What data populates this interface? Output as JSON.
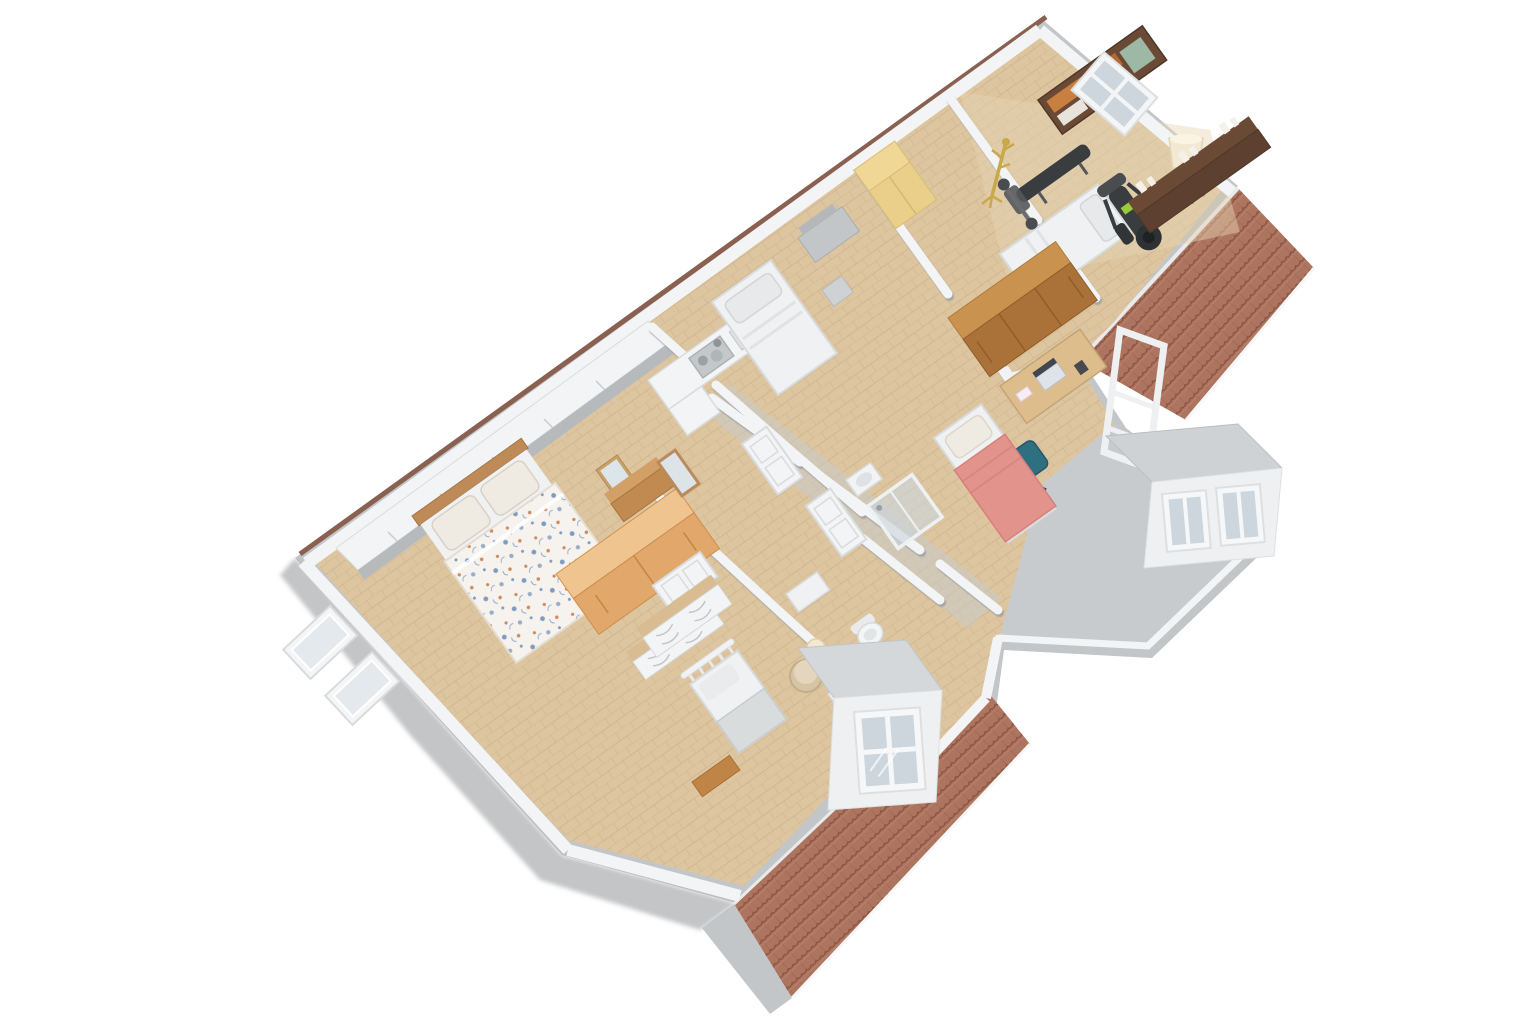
{
  "meta": {
    "description": "3D axonometric floor plan render of an attic apartment, rotated ~35 degrees, floating on a plain white background",
    "view": "top-down isometric cutaway, no labels or UI chrome visible",
    "background": "#ffffff"
  },
  "palette": {
    "slab": "#c3c6c8",
    "slabDark": "#aaadaf",
    "wallTop": "#f3f4f5",
    "wallSide": "#b7babc",
    "wallShadow": "#a2a6a8",
    "wallCapBrown": "#8a6150",
    "floor": "#ddc5a0",
    "floorLight": "#e7d4b4",
    "plankLine": "#c6a87e",
    "grayZone": "#c8cbcd",
    "roofTile": "#ad7560",
    "roofTileDark": "#8a5441",
    "roofTileLight": "#c48d77",
    "roofEdge": "#e8eaeb",
    "pineWood": "#e2a76b",
    "pineWoodTop": "#f0c48f",
    "oakWood": "#aa7238",
    "oakWoodTop": "#c9924e",
    "deskWood": "#ddbd8c",
    "darkWood": "#5d4030",
    "darkWoodTop": "#6b4a35",
    "yellowWardrobe": "#e9cf8a",
    "coralBlanket": "#e2948c",
    "tealChair": "#2e6f80",
    "gymEquipment": "#3a3d40",
    "greenAccent": "#9acb3c",
    "gold": "#c9a84c",
    "lampShade": "#f3e9d3",
    "mattress": "#f0f1f2",
    "pillow": "#efeae2",
    "glass": "#ccd6dc",
    "duvetBlue": "#7f9cc0",
    "duvetOrange": "#cf8a5e"
  },
  "scene": {
    "building": {
      "shape": "long rectangle rotated ~-35deg with beveled top-right corner and stepped lower edge",
      "walls": "white with gray sides, thin brown cap on upper-left exterior wall"
    },
    "roofs": [
      {
        "name": "right-roof",
        "material": "terracotta-tiles",
        "position": "upper-right, sloping down-right"
      },
      {
        "name": "bottom-roof",
        "material": "terracotta-tiles",
        "position": "bottom-center, sloping down-left"
      }
    ],
    "dormers": [
      {
        "name": "right-dormer",
        "windows": 2,
        "position": "right corner"
      },
      {
        "name": "bottom-dormer",
        "windows": 1,
        "position": "on bottom roof"
      },
      {
        "name": "open-window-frame",
        "windows": 0,
        "position": "standing frame at right roof edge"
      }
    ],
    "rooms": [
      {
        "name": "master-bedroom",
        "floor": "light wood",
        "furniture": [
          "wood-headboard",
          "two-pillows",
          "floral-duvet-double-bed",
          "pine-wardrobe",
          "white-dresser",
          "standing-mirror",
          "french-doors"
        ]
      },
      {
        "name": "kitchen",
        "floor": "light wood",
        "furniture": [
          "white-l-counter",
          "sink-with-dishes",
          "white-wall-closets"
        ]
      },
      {
        "name": "middle-bedroom",
        "floor": "light wood",
        "furniture": [
          "white-single-bed",
          "gray-vanity-desk",
          "stool",
          "yellow-wardrobe"
        ]
      },
      {
        "name": "study-bedroom",
        "floor": "light wood",
        "furniture": [
          "white-double-bed",
          "oak-wardrobe",
          "desk-with-laptop",
          "teal-office-chair",
          "coral-single-bed"
        ]
      },
      {
        "name": "home-gym",
        "floor": "light wood",
        "furniture": [
          "dark-bookshelf",
          "gold-coat-rack",
          "weight-bench",
          "elliptical-trainer",
          "tripod-floor-lamp",
          "dark-sideboard-with-candles",
          "roof-window"
        ]
      },
      {
        "name": "kids-room",
        "floor": "light wood",
        "furniture": [
          "slatted-single-bed",
          "wood-bench",
          "white-dresser",
          "side-table-with-lamp"
        ]
      },
      {
        "name": "bathroom",
        "floor": "light wood",
        "furniture": [
          "glass-shower",
          "wash-basin",
          "toilet",
          "laundry-basket",
          "white-stool"
        ]
      },
      {
        "name": "hallway",
        "floor": "light wood",
        "furniture": [
          "wood-dresser",
          "leaning-mirror",
          "white-interior-doors"
        ]
      }
    ]
  }
}
